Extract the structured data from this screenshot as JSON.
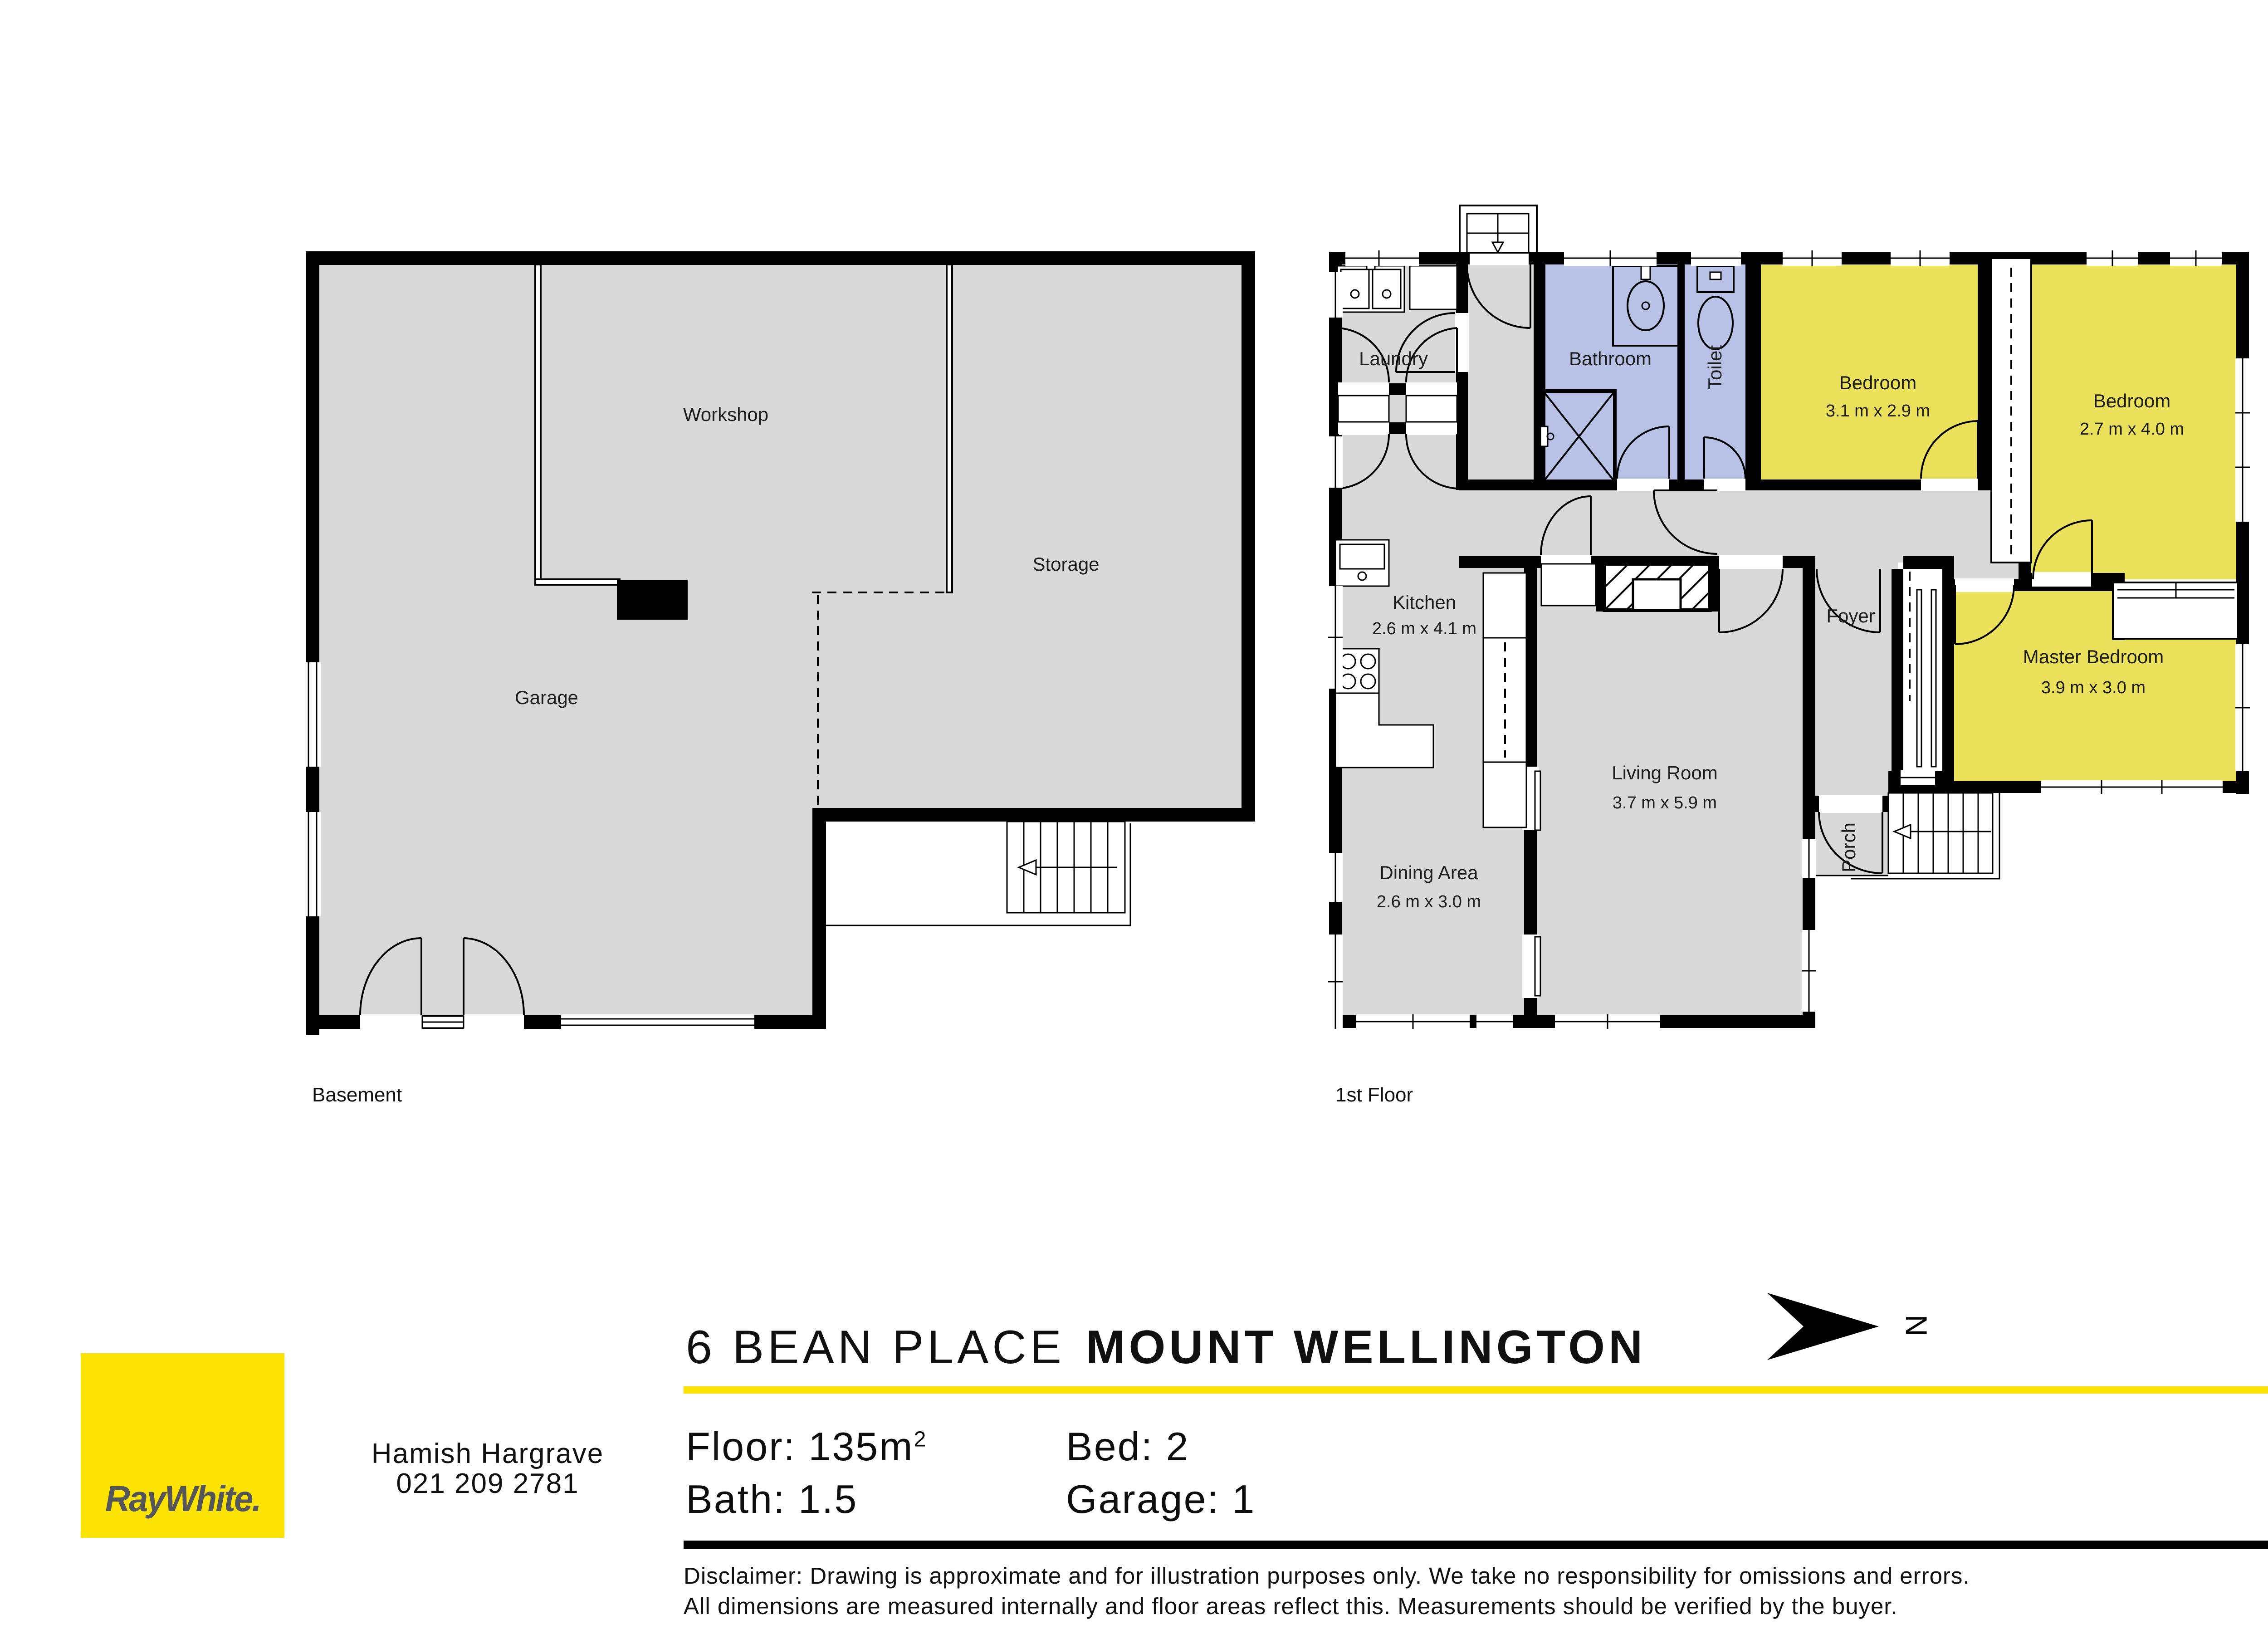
{
  "colors": {
    "wall": "#000000",
    "floor": "#d9d9d9",
    "bedroom": "#ece15b",
    "wet": "#b7c2e6",
    "brand_yellow": "#fce303",
    "logo_text": "#55565a"
  },
  "basement": {
    "title": "Basement",
    "rooms": {
      "workshop": {
        "name": "Workshop"
      },
      "garage": {
        "name": "Garage"
      },
      "storage": {
        "name": "Storage"
      }
    }
  },
  "first_floor": {
    "title": "1st Floor",
    "rooms": {
      "laundry": {
        "name": "Laundry"
      },
      "bathroom": {
        "name": "Bathroom"
      },
      "toilet": {
        "name": "Toilet"
      },
      "bedroom1": {
        "name": "Bedroom",
        "dims": "3.1 m x 2.9 m"
      },
      "bedroom2": {
        "name": "Bedroom",
        "dims": "2.7 m x 4.0 m"
      },
      "kitchen": {
        "name": "Kitchen",
        "dims": "2.6 m x 4.1 m"
      },
      "foyer": {
        "name": "Foyer"
      },
      "master": {
        "name": "Master Bedroom",
        "dims": "3.9 m x 3.0 m"
      },
      "living": {
        "name": "Living Room",
        "dims": "3.7 m x 5.9 m"
      },
      "dining": {
        "name": "Dining Area",
        "dims": "2.6 m x 3.0 m"
      },
      "porch": {
        "name": "Porch"
      }
    }
  },
  "compass": {
    "label": "N"
  },
  "header": {
    "street": "6 BEAN PLACE",
    "suburb": "MOUNT WELLINGTON"
  },
  "agent": {
    "name": "Hamish Hargrave",
    "phone": "021 209 2781"
  },
  "stats": {
    "floor_label": "Floor:",
    "floor_value": "135m",
    "floor_sup": "2",
    "bed_label": "Bed:",
    "bed_value": "2",
    "bath_label": "Bath:",
    "bath_value": "1.5",
    "garage_label": "Garage:",
    "garage_value": "1"
  },
  "disclaimer": {
    "line1": "Disclaimer: Drawing is approximate and for illustration purposes only. We take no responsibility for omissions and errors.",
    "line2": "All dimensions are measured internally and floor areas reflect this. Measurements should be verified by the buyer."
  },
  "brand": {
    "logo_text": "RayWhite."
  }
}
